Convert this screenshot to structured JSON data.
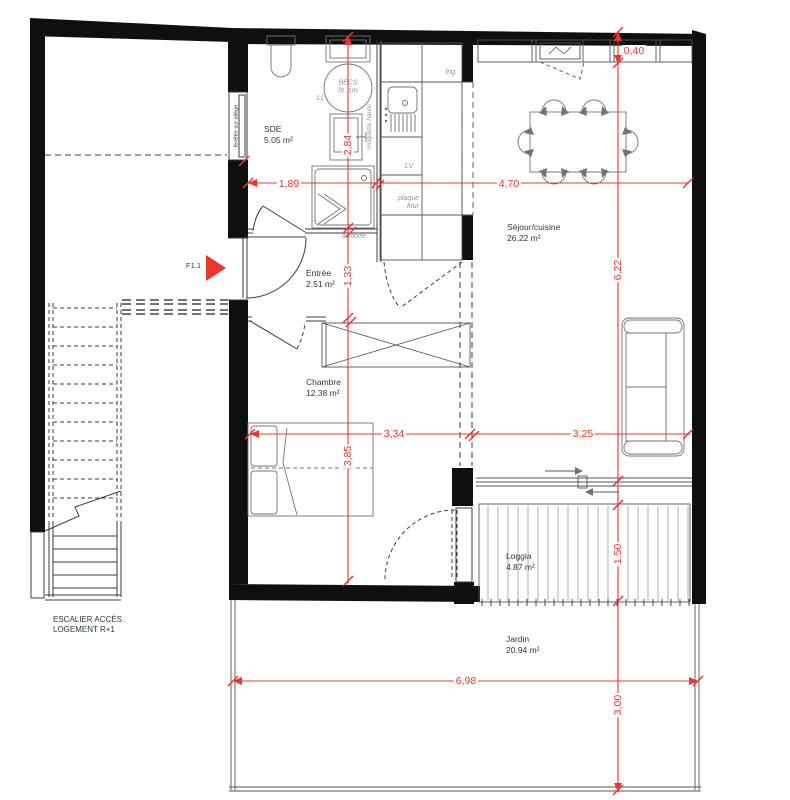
{
  "colors": {
    "dimension_red": "#e8382e",
    "wall_black": "#0f0f0f",
    "label_dark": "#2b3845",
    "label_gray": "#8e949b"
  },
  "rooms": {
    "sde": {
      "name": "SDE",
      "area": "5.05 m²"
    },
    "entree": {
      "name": "Entrée",
      "area": "2.51 m²"
    },
    "chambre": {
      "name": "Chambre",
      "area": "12.38 m²"
    },
    "sejour": {
      "name": "Séjour/cuisine",
      "area": "26.22 m²"
    },
    "loggia": {
      "name": "Loggia",
      "area": "4.87 m²"
    },
    "jardin": {
      "name": "Jardin",
      "area": "20.94 m²"
    }
  },
  "equipment": {
    "becs_line1": "BECS",
    "becs_line2": "ht. 1m",
    "ll": "LL",
    "lv": "LV",
    "frig": "frig.",
    "plaque": "plaque",
    "four": "four",
    "armoire": "armoire",
    "moquette_haute": "moquette haute",
    "fenetre_allege": "fenêtre sur allège"
  },
  "annotations": {
    "door_ref": "F1.1",
    "stair_line1": "ESCALIER ACCÈS",
    "stair_line2": "LOGEMENT R+1"
  },
  "dimensions": {
    "sde_width": "1,89",
    "sejour_width": "4,70",
    "cabinet_depth": "0,40",
    "sde_height": "2,84",
    "entree_height": "1,33",
    "sejour_height": "6,22",
    "chambre_width": "3,34",
    "sejour_lower_width": "3,25",
    "chambre_height": "3,85",
    "loggia_depth": "1,50",
    "jardin_width": "6,98",
    "jardin_depth": "3,00"
  }
}
